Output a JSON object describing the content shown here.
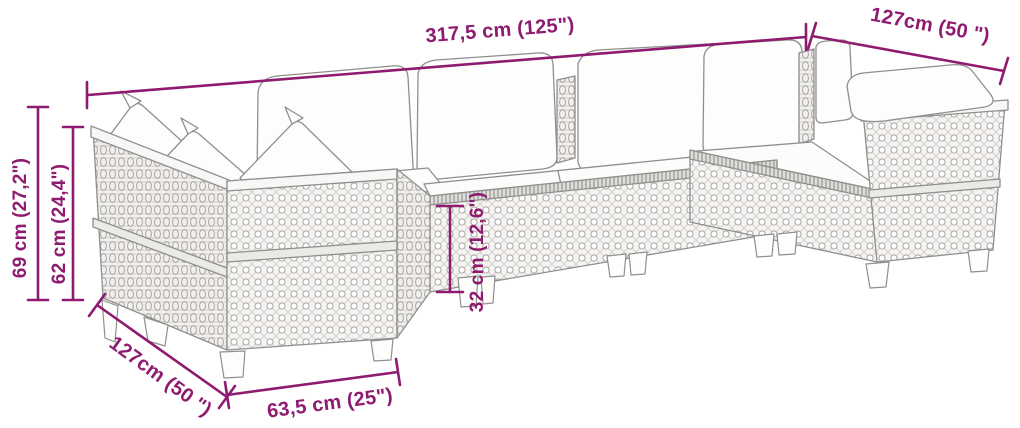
{
  "colors": {
    "dimension_accent": "#8e1b6f",
    "line_art_gray": "#8f8f8f",
    "background": "#ffffff"
  },
  "diagram": {
    "subject": "U-shaped poly rattan garden sofa set with cushions (dimension line drawing)",
    "dimensions": [
      {
        "id": "total-width",
        "label": "317,5 cm (125\")",
        "cm": 317.5,
        "inches": 125
      },
      {
        "id": "right-wing-depth",
        "label": "127cm (50 \")",
        "cm": 127,
        "inches": 50
      },
      {
        "id": "back-height",
        "label": "69 cm (27,2\")",
        "cm": 69,
        "inches": 27.2
      },
      {
        "id": "arm-height",
        "label": "62 cm (24,4\")",
        "cm": 62,
        "inches": 24.4
      },
      {
        "id": "seat-base-height",
        "label": "32 cm (12,6\")",
        "cm": 32,
        "inches": 12.6
      },
      {
        "id": "left-wing-depth",
        "label": "127cm (50 \")",
        "cm": 127,
        "inches": 50
      },
      {
        "id": "module-width",
        "label": "63,5 cm (25\")",
        "cm": 63.5,
        "inches": 25
      }
    ]
  }
}
